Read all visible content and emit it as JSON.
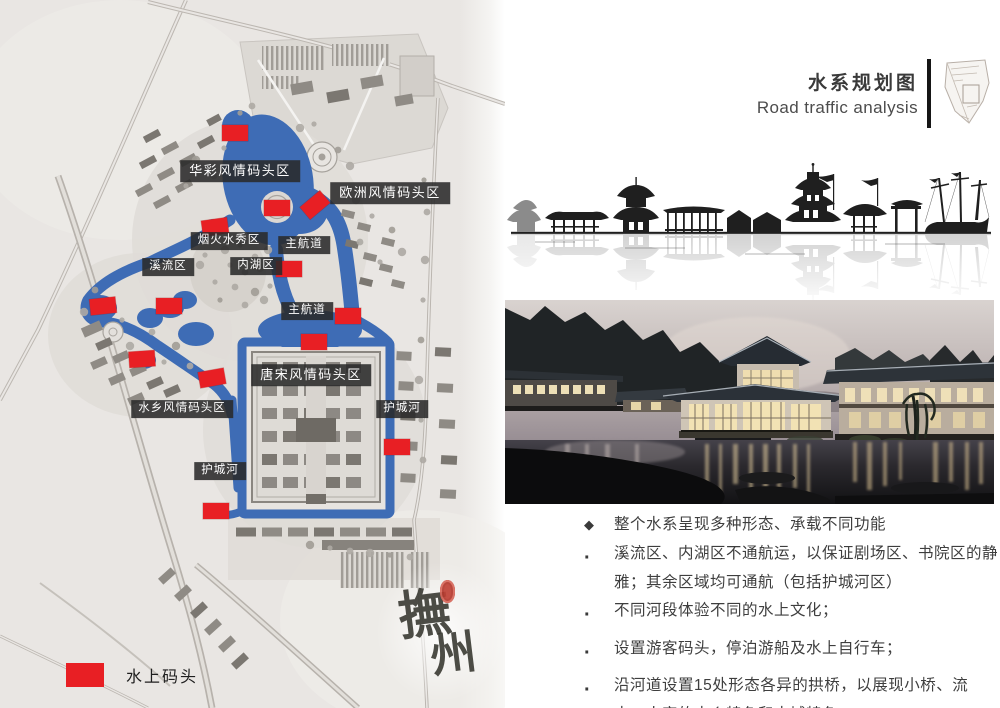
{
  "header": {
    "title_cn": "水系规划图",
    "title_en": "Road traffic analysis"
  },
  "map": {
    "legend": {
      "label": "水上码头"
    },
    "watermark": {
      "text": "撫州"
    },
    "labels": [
      {
        "text": "华彩风情码头区",
        "x": 240,
        "y": 171,
        "big": true
      },
      {
        "text": "欧洲风情码头区",
        "x": 390,
        "y": 193,
        "big": true
      },
      {
        "text": "烟火水秀区",
        "x": 229,
        "y": 241,
        "big": false
      },
      {
        "text": "主航道",
        "x": 304,
        "y": 245,
        "big": false
      },
      {
        "text": "溪流区",
        "x": 168,
        "y": 267,
        "big": false
      },
      {
        "text": "内湖区",
        "x": 256,
        "y": 266,
        "big": false
      },
      {
        "text": "主航道",
        "x": 307,
        "y": 311,
        "big": false
      },
      {
        "text": "唐宋风情码头区",
        "x": 311,
        "y": 375,
        "big": true
      },
      {
        "text": "水乡风情码头区",
        "x": 182,
        "y": 409,
        "big": false
      },
      {
        "text": "护城河",
        "x": 402,
        "y": 409,
        "big": false
      },
      {
        "text": "护城河",
        "x": 220,
        "y": 471,
        "big": false
      }
    ],
    "markers": [
      {
        "x": 235,
        "y": 133,
        "rot": 0
      },
      {
        "x": 277,
        "y": 208,
        "rot": 0
      },
      {
        "x": 315,
        "y": 205,
        "rot": -40
      },
      {
        "x": 215,
        "y": 227,
        "rot": -8
      },
      {
        "x": 289,
        "y": 269,
        "rot": 0
      },
      {
        "x": 103,
        "y": 306,
        "rot": -6
      },
      {
        "x": 169,
        "y": 306,
        "rot": 0
      },
      {
        "x": 348,
        "y": 316,
        "rot": 0
      },
      {
        "x": 314,
        "y": 342,
        "rot": 0
      },
      {
        "x": 142,
        "y": 359,
        "rot": -4
      },
      {
        "x": 212,
        "y": 378,
        "rot": -10
      },
      {
        "x": 397,
        "y": 447,
        "rot": 0
      },
      {
        "x": 216,
        "y": 511,
        "rot": 0
      }
    ]
  },
  "bullets": [
    {
      "marker": "◆",
      "text": "整个水系呈现多种形态、承载不同功能"
    },
    {
      "marker": "·",
      "text": "溪流区、内湖区不通航运，以保证剧场区、书院区的静雅；其余区域均可通航（包括护城河区）"
    },
    {
      "marker": "·",
      "text": "不同河段体验不同的水上文化；"
    },
    {
      "marker": "·",
      "text": "设置游客码头，停泊游船及水上自行车；"
    },
    {
      "marker": "·",
      "text": "沿河道设置15处形态各异的拱桥，以展现小桥、流水、人家的水乡特色和古城特色。"
    }
  ]
}
